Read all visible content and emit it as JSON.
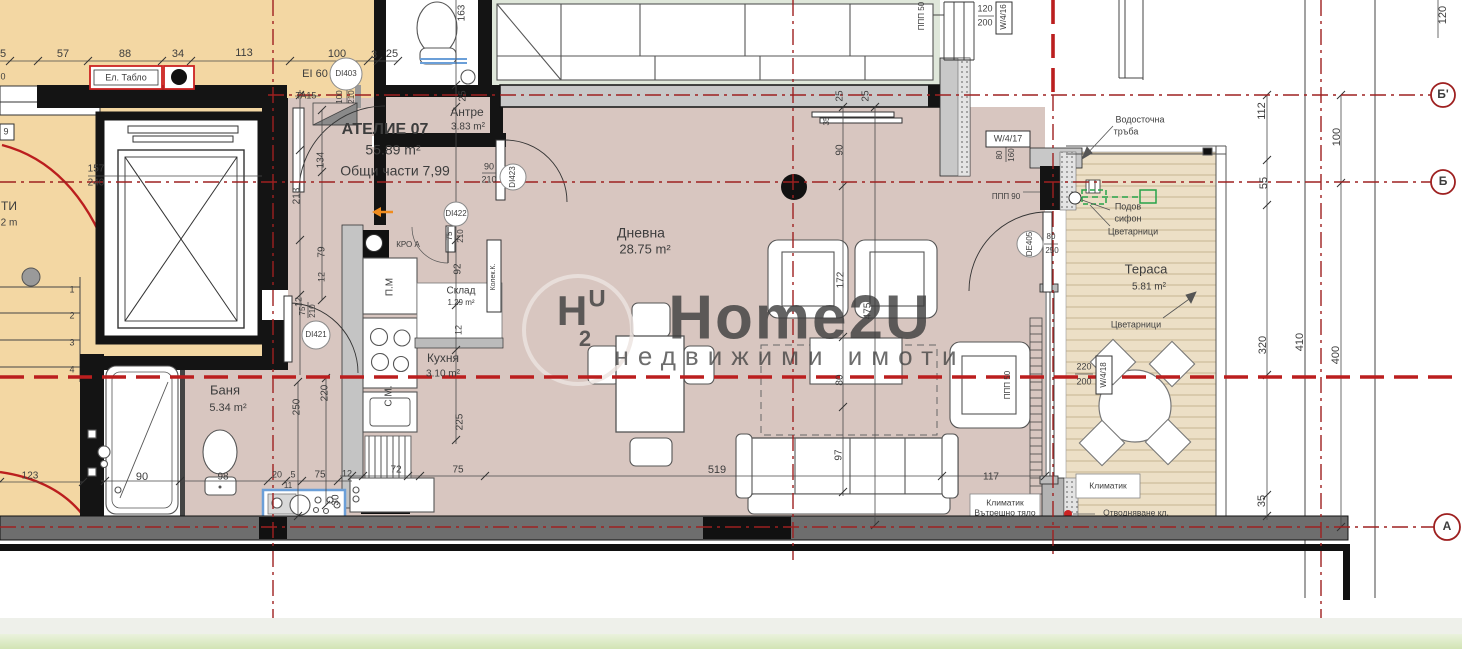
{
  "meta": {
    "kind": "architectural-floor-plan",
    "unit_name": "АТЕЛИЕ 07",
    "unit_area": "55.89 m²",
    "unit_common": "Общи части 7,99"
  },
  "colors": {
    "floor_common": "#f3d7a3",
    "floor_unit": "#d8c6c0",
    "floor_neighbor": "#dfe7da",
    "floor_terrace": "#ecdfc6",
    "deck_line": "#cdbc9c",
    "wall_black": "#141414",
    "wall_gray": "#c8c8c8",
    "band_gray": "#6e6e6e",
    "axis_red": "#9e2020",
    "section_red": "#bb1e1e",
    "dim_text": "#3d3d3d",
    "room_text": "#4a4a4a",
    "muted_text": "#8a8a8a",
    "tag_red": "#d93025",
    "blue_text": "#5b79a8",
    "fixture_blue": "#6b9fd8",
    "green_accent": "#27a348",
    "orange_accent": "#f08c1e",
    "watermark": "#ece4e0",
    "strip_light": "#eef0ea",
    "strip_green_top": "#eaf2dd",
    "strip_green_bottom": "#d2e4b4"
  },
  "rooms": [
    {
      "name": "Антре",
      "area": "3.83 m²"
    },
    {
      "name": "Дневна",
      "area": "28.75 m²"
    },
    {
      "name": "Кухня",
      "area": "3.10 m²"
    },
    {
      "name": "Склад",
      "area": "1.29 m²"
    },
    {
      "name": "Баня",
      "area": "5.34 m²"
    },
    {
      "name": "Тераса",
      "area": "5.81 m²"
    }
  ],
  "labels": [
    {
      "t": "5",
      "x": 3,
      "y": 54,
      "s": 11,
      "k": "dim"
    },
    {
      "t": "57",
      "x": 63,
      "y": 54,
      "s": 11,
      "k": "dim"
    },
    {
      "t": "88",
      "x": 125,
      "y": 54,
      "s": 11,
      "k": "dim"
    },
    {
      "t": "34",
      "x": 178,
      "y": 54,
      "s": 11,
      "k": "dim"
    },
    {
      "t": "113",
      "x": 244,
      "y": 53,
      "s": 11,
      "k": "dim"
    },
    {
      "t": "100",
      "x": 337,
      "y": 54,
      "s": 11,
      "k": "dim"
    },
    {
      "t": "3",
      "x": 374,
      "y": 55,
      "s": 11,
      "k": "dim"
    },
    {
      "t": "25",
      "x": 392,
      "y": 54,
      "s": 11,
      "k": "dim"
    },
    {
      "t": "0",
      "x": 3,
      "y": 77,
      "s": 9,
      "k": "dim"
    },
    {
      "t": "163",
      "x": 462,
      "y": 13,
      "s": 10,
      "r": -90,
      "k": "dim"
    },
    {
      "t": "25",
      "x": 463,
      "y": 96,
      "s": 10,
      "r": -90,
      "k": "dim"
    },
    {
      "t": "25",
      "x": 840,
      "y": 96,
      "s": 10,
      "r": -90,
      "k": "dim"
    },
    {
      "t": "25",
      "x": 866,
      "y": 96,
      "s": 10,
      "r": -90,
      "k": "dim"
    },
    {
      "t": "35",
      "x": 827,
      "y": 121,
      "s": 8,
      "r": -90,
      "k": "dim"
    },
    {
      "t": "90",
      "x": 840,
      "y": 150,
      "s": 10,
      "r": -90,
      "k": "dim"
    },
    {
      "t": "172",
      "x": 841,
      "y": 280,
      "s": 10,
      "r": -90,
      "k": "dim"
    },
    {
      "t": "475",
      "x": 868,
      "y": 311,
      "s": 10,
      "r": -90,
      "k": "dim"
    },
    {
      "t": "80",
      "x": 840,
      "y": 380,
      "s": 10,
      "r": -90,
      "k": "dim"
    },
    {
      "t": "97",
      "x": 839,
      "y": 455,
      "s": 10,
      "r": -90,
      "k": "dim"
    },
    {
      "t": "117",
      "x": 991,
      "y": 477,
      "s": 10,
      "k": "dim"
    },
    {
      "t": "519",
      "x": 717,
      "y": 470,
      "s": 11,
      "k": "dim"
    },
    {
      "t": "75",
      "x": 458,
      "y": 470,
      "s": 10,
      "k": "dim"
    },
    {
      "t": "72",
      "x": 396,
      "y": 470,
      "s": 10,
      "k": "dim"
    },
    {
      "t": "123",
      "x": 30,
      "y": 476,
      "s": 10,
      "k": "dim"
    },
    {
      "t": "90",
      "x": 142,
      "y": 477,
      "s": 11,
      "c": "blue_text",
      "k": "dim"
    },
    {
      "t": "98",
      "x": 223,
      "y": 477,
      "s": 10,
      "k": "dim"
    },
    {
      "t": "20",
      "x": 277,
      "y": 475,
      "s": 9,
      "k": "dim"
    },
    {
      "t": "5",
      "x": 293,
      "y": 475,
      "s": 9,
      "k": "dim"
    },
    {
      "t": "75",
      "x": 320,
      "y": 475,
      "s": 10,
      "k": "dim"
    },
    {
      "t": "12",
      "x": 347,
      "y": 474,
      "s": 9,
      "k": "dim"
    },
    {
      "t": "11",
      "x": 288,
      "y": 486,
      "s": 8,
      "k": "dim"
    },
    {
      "t": "30",
      "x": 336,
      "y": 500,
      "s": 10,
      "r": -90,
      "k": "dim"
    },
    {
      "t": "250",
      "x": 297,
      "y": 407,
      "s": 10,
      "r": -90,
      "k": "dim"
    },
    {
      "t": "220",
      "x": 325,
      "y": 393,
      "s": 10,
      "r": -90,
      "k": "dim"
    },
    {
      "t": "Баня",
      "x": 225,
      "y": 391,
      "s": 13,
      "c": "room_text",
      "k": "room-name"
    },
    {
      "t": "5.34 m²",
      "x": 228,
      "y": 408,
      "s": 11,
      "k": "room-area"
    },
    {
      "t": "157",
      "x": 96,
      "y": 169,
      "s": 10,
      "k": "dim"
    },
    {
      "t": "240",
      "x": 96,
      "y": 183,
      "s": 10,
      "k": "dim"
    },
    {
      "t": "9",
      "x": 6,
      "y": 132,
      "s": 9,
      "k": "dim"
    },
    {
      "t": "ТИ",
      "x": 9,
      "y": 207,
      "s": 12,
      "c": "room_text",
      "k": "room-name"
    },
    {
      "t": "2 m",
      "x": 9,
      "y": 223,
      "s": 10,
      "k": "room-area"
    },
    {
      "t": "1",
      "x": 72,
      "y": 290,
      "s": 9,
      "k": "dim"
    },
    {
      "t": "2",
      "x": 72,
      "y": 316,
      "s": 9,
      "k": "dim"
    },
    {
      "t": "3",
      "x": 72,
      "y": 343,
      "s": 9,
      "k": "dim"
    },
    {
      "t": "4",
      "x": 72,
      "y": 370,
      "s": 9,
      "k": "dim"
    },
    {
      "t": "Ел. Табло",
      "x": 126,
      "y": 78,
      "s": 9,
      "k": "annotation"
    },
    {
      "t": "EI 60",
      "x": 315,
      "y": 74,
      "s": 11,
      "k": "annotation"
    },
    {
      "t": "DI403",
      "x": 346,
      "y": 74,
      "s": 8,
      "k": "door-tag"
    },
    {
      "t": "TA15",
      "x": 306,
      "y": 96,
      "s": 9,
      "k": "door-tag"
    },
    {
      "t": "100",
      "x": 340,
      "y": 97,
      "s": 8,
      "r": -90,
      "k": "dim"
    },
    {
      "t": "210",
      "x": 352,
      "y": 97,
      "s": 8,
      "r": -90,
      "k": "dim"
    },
    {
      "t": "АТЕЛИЕ 07",
      "x": 385,
      "y": 130,
      "s": 16,
      "b": 1,
      "c": "room_text",
      "k": "unit-name"
    },
    {
      "t": "55.89 m²",
      "x": 393,
      "y": 151,
      "s": 14,
      "k": "unit-area"
    },
    {
      "t": "Общи части 7,99",
      "x": 395,
      "y": 172,
      "s": 14,
      "k": "unit-common"
    },
    {
      "t": "Антре",
      "x": 467,
      "y": 113,
      "s": 12,
      "c": "room_text",
      "k": "room-name"
    },
    {
      "t": "3.83 m²",
      "x": 468,
      "y": 127,
      "s": 10,
      "k": "room-area"
    },
    {
      "t": "90",
      "x": 489,
      "y": 167,
      "s": 9,
      "k": "dim"
    },
    {
      "t": "210",
      "x": 489,
      "y": 180,
      "s": 9,
      "k": "dim"
    },
    {
      "t": "DI423",
      "x": 513,
      "y": 177,
      "s": 8,
      "r": -90,
      "k": "door-tag"
    },
    {
      "t": "DI422",
      "x": 456,
      "y": 214,
      "s": 8,
      "k": "door-tag"
    },
    {
      "t": "75",
      "x": 450,
      "y": 236,
      "s": 8,
      "r": -90,
      "k": "dim"
    },
    {
      "t": "210",
      "x": 461,
      "y": 236,
      "s": 8,
      "r": -90,
      "k": "dim"
    },
    {
      "t": "КРО А",
      "x": 408,
      "y": 245,
      "s": 8,
      "c": "tag_red",
      "k": "annotation"
    },
    {
      "t": "П.М",
      "x": 390,
      "y": 287,
      "s": 10,
      "r": -90,
      "c": "muted_text",
      "k": "annotation"
    },
    {
      "t": "Склад",
      "x": 461,
      "y": 291,
      "s": 10,
      "c": "room_text",
      "k": "room-name"
    },
    {
      "t": "1.29 m²",
      "x": 461,
      "y": 303,
      "s": 8,
      "k": "room-area"
    },
    {
      "t": "Колек.К.",
      "x": 493,
      "y": 277,
      "s": 7,
      "r": -90,
      "k": "annotation"
    },
    {
      "t": "92",
      "x": 458,
      "y": 269,
      "s": 10,
      "r": -90,
      "k": "dim"
    },
    {
      "t": "12",
      "x": 459,
      "y": 330,
      "s": 9,
      "r": -90,
      "k": "dim"
    },
    {
      "t": "225",
      "x": 460,
      "y": 422,
      "s": 10,
      "r": -90,
      "k": "dim"
    },
    {
      "t": "Кухня",
      "x": 443,
      "y": 359,
      "s": 12,
      "c": "room_text",
      "k": "room-name"
    },
    {
      "t": "3.10 m²",
      "x": 443,
      "y": 374,
      "s": 10,
      "k": "room-area"
    },
    {
      "t": "С.М.",
      "x": 389,
      "y": 396,
      "s": 10,
      "r": -90,
      "c": "muted_text",
      "k": "annotation"
    },
    {
      "t": "134",
      "x": 321,
      "y": 160,
      "s": 10,
      "r": -90,
      "k": "dim"
    },
    {
      "t": "213",
      "x": 297,
      "y": 196,
      "s": 10,
      "r": -90,
      "k": "dim"
    },
    {
      "t": "79",
      "x": 322,
      "y": 252,
      "s": 10,
      "r": -90,
      "k": "dim"
    },
    {
      "t": "12",
      "x": 322,
      "y": 277,
      "s": 9,
      "r": -90,
      "k": "dim"
    },
    {
      "t": "12",
      "x": 299,
      "y": 302,
      "s": 9,
      "r": -90,
      "k": "dim"
    },
    {
      "t": "75",
      "x": 303,
      "y": 311,
      "s": 8,
      "r": -90,
      "k": "dim"
    },
    {
      "t": "210",
      "x": 313,
      "y": 311,
      "s": 8,
      "r": -90,
      "k": "dim"
    },
    {
      "t": "DI421",
      "x": 316,
      "y": 335,
      "s": 8,
      "k": "door-tag"
    },
    {
      "t": "Дневна",
      "x": 641,
      "y": 234,
      "s": 14,
      "c": "room_text",
      "k": "room-name"
    },
    {
      "t": "28.75 m²",
      "x": 645,
      "y": 250,
      "s": 13,
      "k": "room-area"
    },
    {
      "t": "ППП 50",
      "x": 922,
      "y": 16,
      "s": 8,
      "r": -90,
      "k": "annotation"
    },
    {
      "t": "120",
      "x": 985,
      "y": 9,
      "s": 9,
      "k": "dim"
    },
    {
      "t": "200",
      "x": 985,
      "y": 23,
      "s": 9,
      "k": "dim"
    },
    {
      "t": "W/4/16",
      "x": 1004,
      "y": 17,
      "s": 8,
      "r": -90,
      "k": "window-tag"
    },
    {
      "t": "W/4/17",
      "x": 1008,
      "y": 139,
      "s": 9,
      "k": "window-tag"
    },
    {
      "t": "80",
      "x": 1000,
      "y": 155,
      "s": 8,
      "r": -90,
      "k": "dim"
    },
    {
      "t": "160",
      "x": 1012,
      "y": 155,
      "s": 8,
      "r": -90,
      "k": "dim"
    },
    {
      "t": "ППП 90",
      "x": 1006,
      "y": 197,
      "s": 8,
      "k": "annotation"
    },
    {
      "t": "DE405",
      "x": 1030,
      "y": 244,
      "s": 8,
      "r": -90,
      "k": "door-tag"
    },
    {
      "t": "80",
      "x": 1051,
      "y": 237,
      "s": 8,
      "k": "dim"
    },
    {
      "t": "250",
      "x": 1052,
      "y": 251,
      "s": 8,
      "k": "dim"
    },
    {
      "t": "ППП 50",
      "x": 1008,
      "y": 385,
      "s": 8,
      "r": -90,
      "k": "annotation"
    },
    {
      "t": "Водосточна",
      "x": 1140,
      "y": 120,
      "s": 9,
      "k": "annotation"
    },
    {
      "t": "тръба",
      "x": 1126,
      "y": 132,
      "s": 9,
      "k": "annotation"
    },
    {
      "t": "Подов",
      "x": 1128,
      "y": 207,
      "s": 9,
      "k": "annotation"
    },
    {
      "t": "сифон",
      "x": 1128,
      "y": 219,
      "s": 9,
      "k": "annotation"
    },
    {
      "t": "Цветарници",
      "x": 1133,
      "y": 232,
      "s": 9,
      "k": "annotation"
    },
    {
      "t": "Тераса",
      "x": 1146,
      "y": 270,
      "s": 13,
      "c": "room_text",
      "k": "room-name"
    },
    {
      "t": "5.81 m²",
      "x": 1149,
      "y": 287,
      "s": 10,
      "k": "room-area"
    },
    {
      "t": "Цветарници",
      "x": 1136,
      "y": 325,
      "s": 9,
      "k": "annotation"
    },
    {
      "t": "220",
      "x": 1084,
      "y": 367,
      "s": 9,
      "k": "dim"
    },
    {
      "t": "200",
      "x": 1084,
      "y": 382,
      "s": 9,
      "k": "dim"
    },
    {
      "t": "W/4/18",
      "x": 1104,
      "y": 375,
      "s": 8,
      "r": -90,
      "k": "window-tag"
    },
    {
      "t": "Климатик",
      "x": 1108,
      "y": 486,
      "s": 8.5,
      "k": "annotation"
    },
    {
      "t": "Климатик",
      "x": 1005,
      "y": 503,
      "s": 8.5,
      "k": "annotation"
    },
    {
      "t": "Вътрешно тяло",
      "x": 1005,
      "y": 513,
      "s": 8.5,
      "k": "annotation"
    },
    {
      "t": "Отводняване кл.",
      "x": 1136,
      "y": 513,
      "s": 8.5,
      "k": "annotation"
    },
    {
      "t": "112",
      "x": 1262,
      "y": 111,
      "s": 11,
      "r": -90,
      "k": "dim"
    },
    {
      "t": "55",
      "x": 1264,
      "y": 183,
      "s": 11,
      "r": -90,
      "k": "dim"
    },
    {
      "t": "320",
      "x": 1263,
      "y": 345,
      "s": 11,
      "r": -90,
      "k": "dim"
    },
    {
      "t": "35",
      "x": 1262,
      "y": 501,
      "s": 11,
      "r": -90,
      "k": "dim"
    },
    {
      "t": "410",
      "x": 1300,
      "y": 342,
      "s": 11,
      "r": -90,
      "k": "dim"
    },
    {
      "t": "400",
      "x": 1336,
      "y": 355,
      "s": 11,
      "r": -90,
      "k": "dim"
    },
    {
      "t": "100",
      "x": 1337,
      "y": 137,
      "s": 11,
      "r": -90,
      "k": "dim"
    },
    {
      "t": "120",
      "x": 1443,
      "y": 15,
      "s": 11,
      "r": -90,
      "k": "dim"
    },
    {
      "t": "Б'",
      "x": 1443,
      "y": 95,
      "s": 12,
      "b": 1,
      "c": "axis_red",
      "k": "axis-marker"
    },
    {
      "t": "Б",
      "x": 1443,
      "y": 182,
      "s": 12,
      "b": 1,
      "c": "axis_red",
      "k": "axis-marker"
    },
    {
      "t": "А",
      "x": 1447,
      "y": 527,
      "s": 12,
      "b": 1,
      "c": "axis_red",
      "k": "axis-marker"
    },
    {
      "t": "Home2U",
      "x": 800,
      "y": 322,
      "s": 62,
      "b": 1,
      "c": "watermark",
      "o": 0.8,
      "ls": 2,
      "k": "watermark"
    },
    {
      "t": "недвижими имоти",
      "x": 790,
      "y": 358,
      "s": 26,
      "c": "watermark",
      "o": 0.75,
      "ls": 9,
      "k": "watermark"
    },
    {
      "t": "H",
      "x": 572,
      "y": 314,
      "s": 42,
      "b": 1,
      "c": "watermark",
      "o": 0.8,
      "k": "watermark"
    },
    {
      "t": "2",
      "x": 585,
      "y": 340,
      "s": 22,
      "b": 1,
      "c": "watermark",
      "o": 0.8,
      "k": "watermark"
    },
    {
      "t": "U",
      "x": 597,
      "y": 300,
      "s": 24,
      "b": 1,
      "c": "watermark",
      "o": 0.8,
      "k": "watermark"
    }
  ]
}
